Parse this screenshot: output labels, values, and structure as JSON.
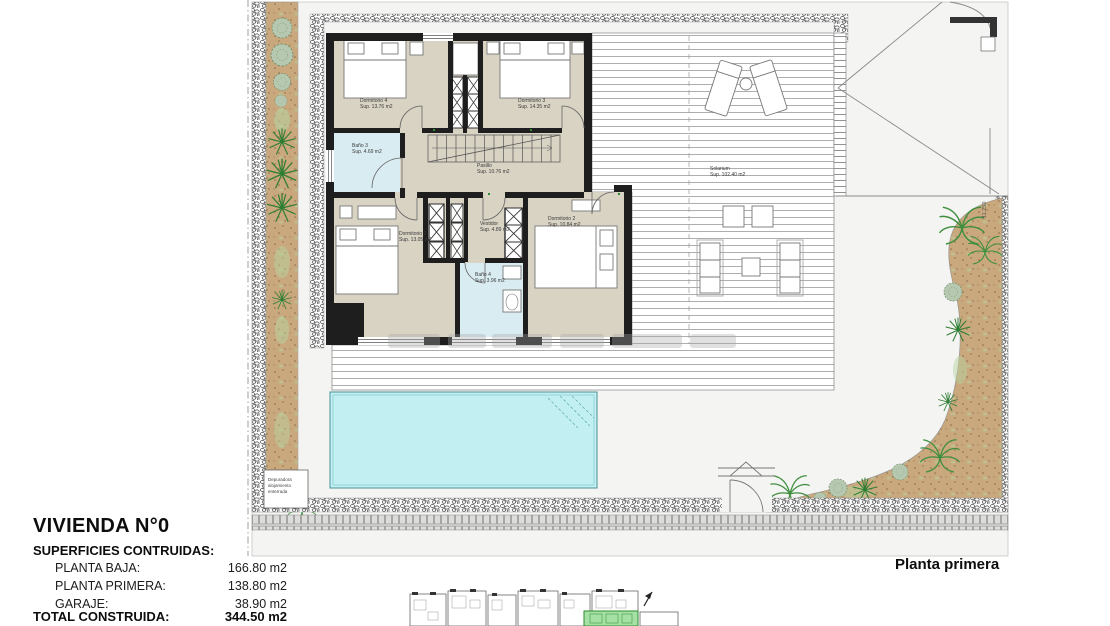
{
  "title": "VIVIENDA N°0",
  "plan_label": "Planta primera",
  "areas_table": {
    "heading": "SUPERFICIES CONTRUIDAS:",
    "rows": [
      {
        "label": "PLANTA BAJA:",
        "value": "166.80 m2"
      },
      {
        "label": "PLANTA PRIMERA:",
        "value": "138.80 m2"
      },
      {
        "label": "GARAJE:",
        "value": "38.90 m2"
      }
    ],
    "total": {
      "label": "TOTAL CONSTRUIDA:",
      "value": "344.50 m2"
    }
  },
  "rooms": [
    {
      "name": "Dormitorio 4",
      "area": "Sup. 13.76 m2"
    },
    {
      "name": "Dormitorio 3",
      "area": "Sup. 14.35 m2"
    },
    {
      "name": "Baño 3",
      "area": "Sup. 4.69 m2"
    },
    {
      "name": "Pasillo",
      "area": "Sup. 10.76 m2"
    },
    {
      "name": "Dormitorio 1",
      "area": "Sup. 13.05 m2"
    },
    {
      "name": "Vestidor",
      "area": "Sup. 4.89 m2"
    },
    {
      "name": "Baño 4",
      "area": "Sup. 3.96 m2"
    },
    {
      "name": "Dormitorio 2",
      "area": "Sup. 10.84 m2"
    },
    {
      "name": "Solarium",
      "area": "Sup. 102.40 m2"
    }
  ],
  "annotations": {
    "depuradora_note": "Depuradora alojamiento enterrada",
    "boundary_dimension": "11.250"
  },
  "icons": {
    "north_arrow": "north-arrow"
  },
  "colors": {
    "wall": "#1e1e1e",
    "room_fill": "#d9d3c4",
    "bath_fill": "#d9ecf1",
    "pool_fill": "#c2f0f2",
    "soil": "#c9a87e",
    "plant_green": "#2e7d32",
    "highlight_green": "#a5e0a5"
  }
}
